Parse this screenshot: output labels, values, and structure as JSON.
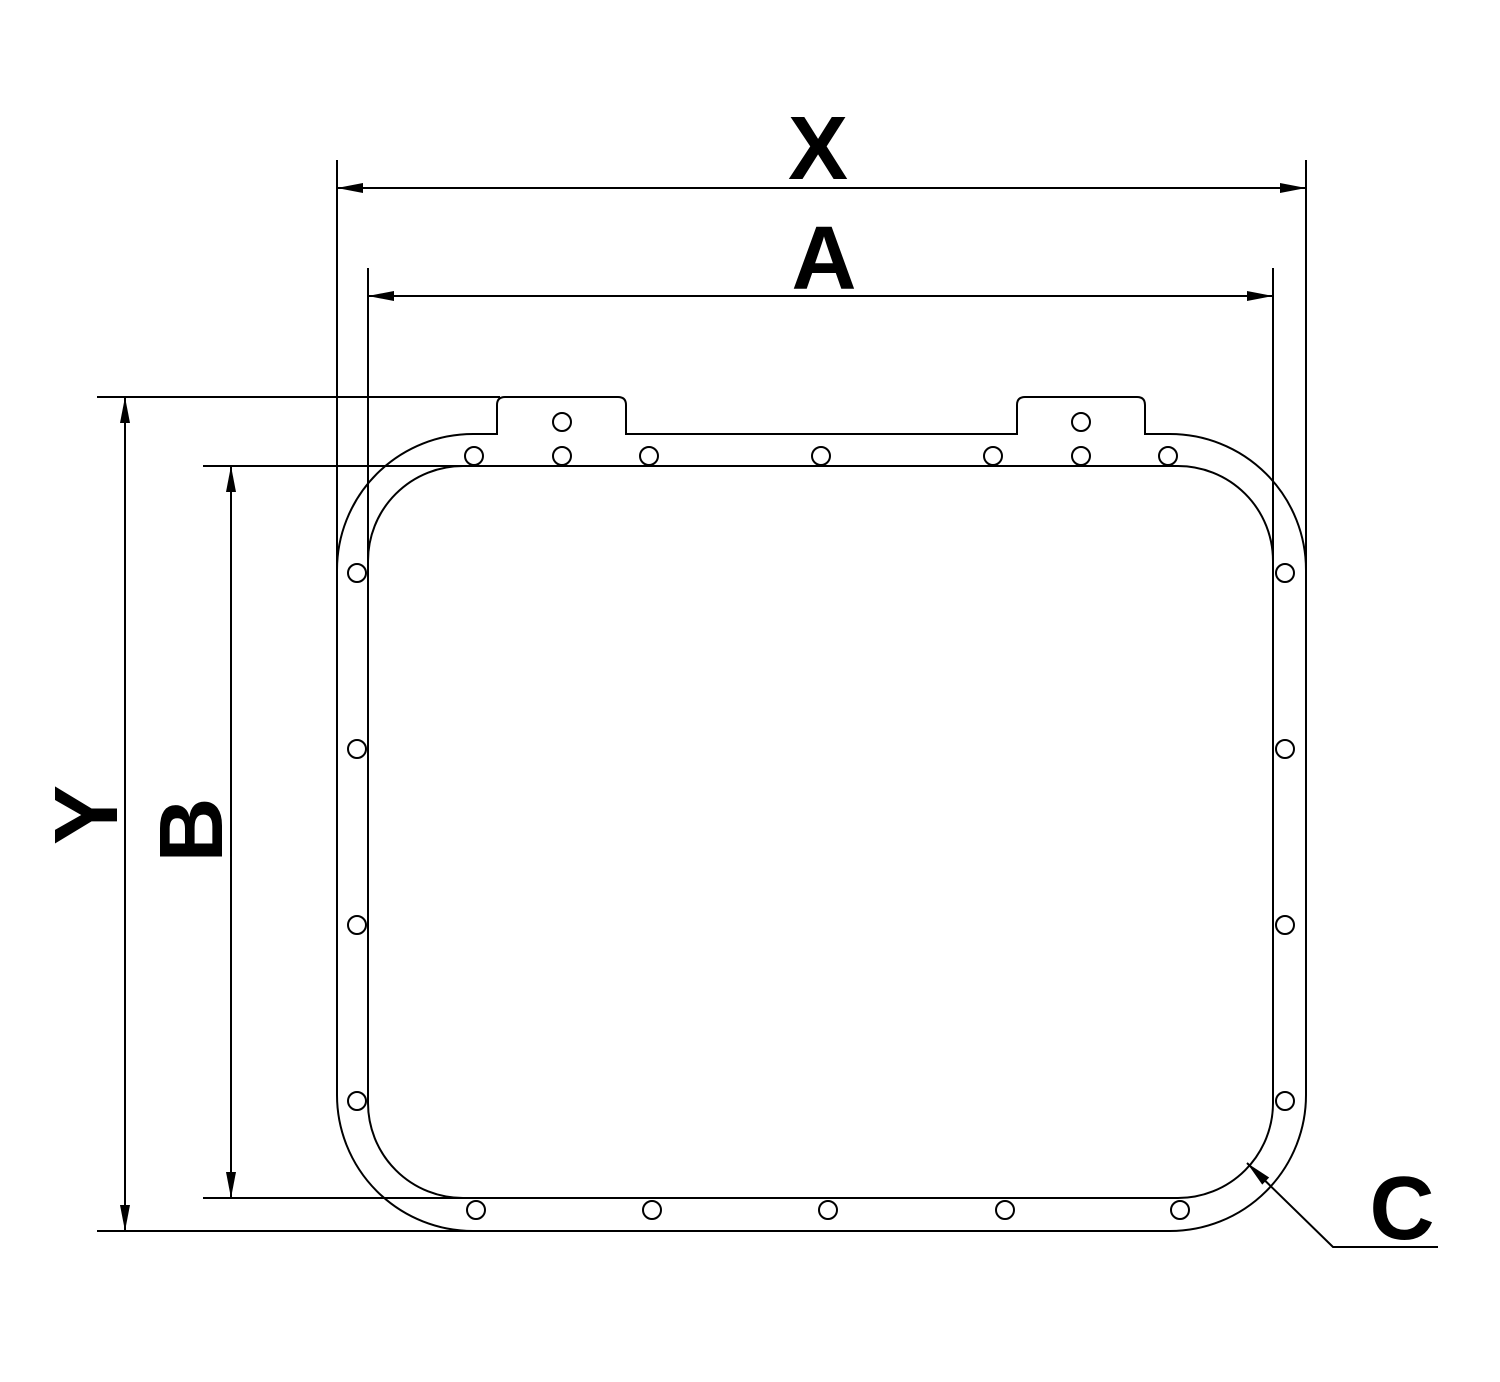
{
  "labels": {
    "x": "X",
    "a": "A",
    "y": "Y",
    "b": "B",
    "c": "C"
  },
  "colors": {
    "line": "#000000",
    "background": "#ffffff",
    "text": "#000000"
  },
  "canvas": {
    "width": 1500,
    "height": 1382
  },
  "frame": {
    "outer": {
      "left": 337,
      "top": 434,
      "right": 1306,
      "bottom": 1231,
      "corner_radius": 136
    },
    "inner": {
      "left": 368,
      "top": 466,
      "right": 1273,
      "bottom": 1198,
      "corner_radius": 95
    },
    "tabs": [
      {
        "left": 497,
        "right": 626,
        "top": 397,
        "corner_radius": 8
      },
      {
        "left": 1017,
        "right": 1145,
        "top": 397,
        "corner_radius": 8
      }
    ],
    "hole_radius": 9,
    "holes": [
      [
        474,
        456
      ],
      [
        562,
        456
      ],
      [
        649,
        456
      ],
      [
        821,
        456
      ],
      [
        993,
        456
      ],
      [
        1081,
        456
      ],
      [
        1168,
        456
      ],
      [
        562,
        422
      ],
      [
        1081,
        422
      ],
      [
        357,
        573
      ],
      [
        357,
        749
      ],
      [
        357,
        925
      ],
      [
        357,
        1101
      ],
      [
        1285,
        573
      ],
      [
        1285,
        749
      ],
      [
        1285,
        925
      ],
      [
        1285,
        1101
      ],
      [
        476,
        1210
      ],
      [
        652,
        1210
      ],
      [
        828,
        1210
      ],
      [
        1005,
        1210
      ],
      [
        1180,
        1210
      ]
    ]
  },
  "dimensions": {
    "x": {
      "line": [
        337,
        188,
        1306,
        188
      ],
      "extensions": [
        [
          337,
          160,
          337,
          575
        ],
        [
          1306,
          160,
          1306,
          575
        ]
      ],
      "arrows": [
        [
          337,
          188,
          180
        ],
        [
          1306,
          188,
          0
        ]
      ]
    },
    "a": {
      "line": [
        368,
        296,
        1273,
        296
      ],
      "extensions": [
        [
          368,
          268,
          368,
          565
        ],
        [
          1273,
          268,
          1273,
          565
        ]
      ],
      "arrows": [
        [
          368,
          296,
          180
        ],
        [
          1273,
          296,
          0
        ]
      ]
    },
    "y": {
      "line": [
        125,
        397,
        125,
        1231
      ],
      "extensions": [
        [
          97,
          397,
          500,
          397
        ],
        [
          97,
          1231,
          476,
          1231
        ]
      ],
      "arrows": [
        [
          125,
          397,
          270
        ],
        [
          125,
          1231,
          90
        ]
      ]
    },
    "b": {
      "line": [
        231,
        466,
        231,
        1198
      ],
      "extensions": [
        [
          203,
          466,
          466,
          466
        ],
        [
          203,
          1198,
          466,
          1198
        ]
      ],
      "arrows": [
        [
          231,
          466,
          270
        ],
        [
          231,
          1198,
          90
        ]
      ]
    },
    "c": {
      "leader": [
        [
          1247,
          1163
        ],
        [
          1333,
          1247
        ],
        [
          1438,
          1247
        ]
      ],
      "arrow": [
        1247,
        1163,
        224
      ]
    }
  },
  "style": {
    "stroke_width": 2,
    "arrow_length": 26,
    "arrow_half_width": 5
  }
}
